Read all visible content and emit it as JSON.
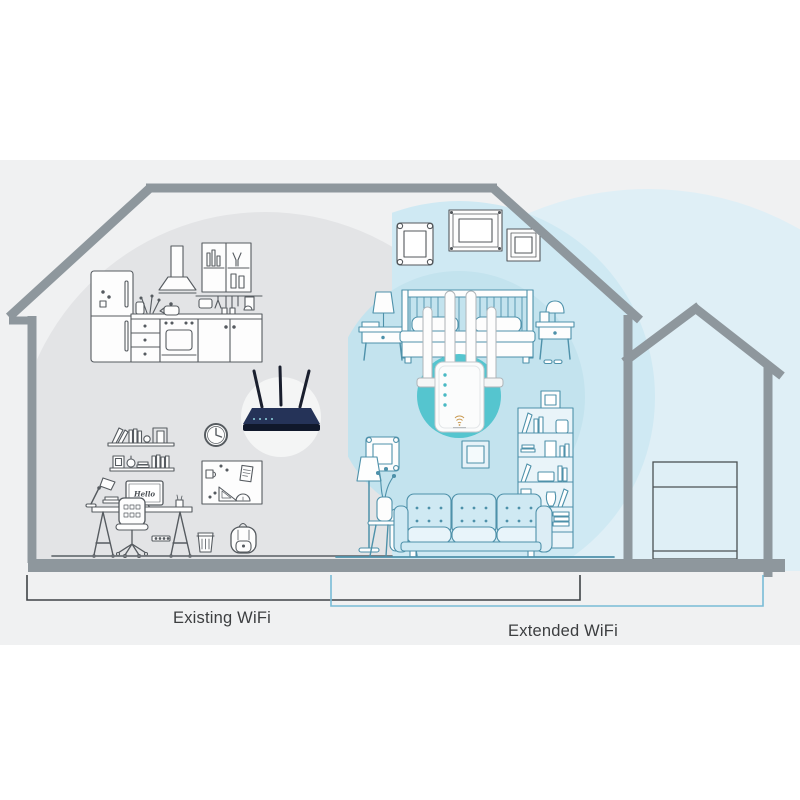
{
  "scene": {
    "type": "wifi-range-extender-coverage-illustration",
    "labels": {
      "existing_wifi": "Existing WiFi",
      "extended_wifi": "Extended WiFi"
    },
    "monitor_screen_text": "Hello",
    "colors": {
      "canvas": "#ffffff",
      "backdrop": "#f0f1f2",
      "house_outline": "#8e979d",
      "existing_zone": "#e3e4e6",
      "extended_zone_outer": "#dfeff6",
      "extended_zone_mid": "#cfe9f3",
      "extended_zone_inner": "#c3e3ee",
      "extender_halo": "#55c5cf",
      "router_halo": "#f4f5f5",
      "router_body": "#253358",
      "router_base": "#10182b",
      "dark_line_art": "#565b60",
      "teal_line_art": "#4e91aa",
      "existing_bracket": "#3f4347",
      "extended_bracket": "#79bcd6",
      "label_text": "#3c3e40"
    },
    "icons": {
      "router": "wireless-router-3-antennas",
      "extender": "wifi-repeater-4-antennas",
      "extender_logo": "wifi-arcs-logo"
    }
  }
}
